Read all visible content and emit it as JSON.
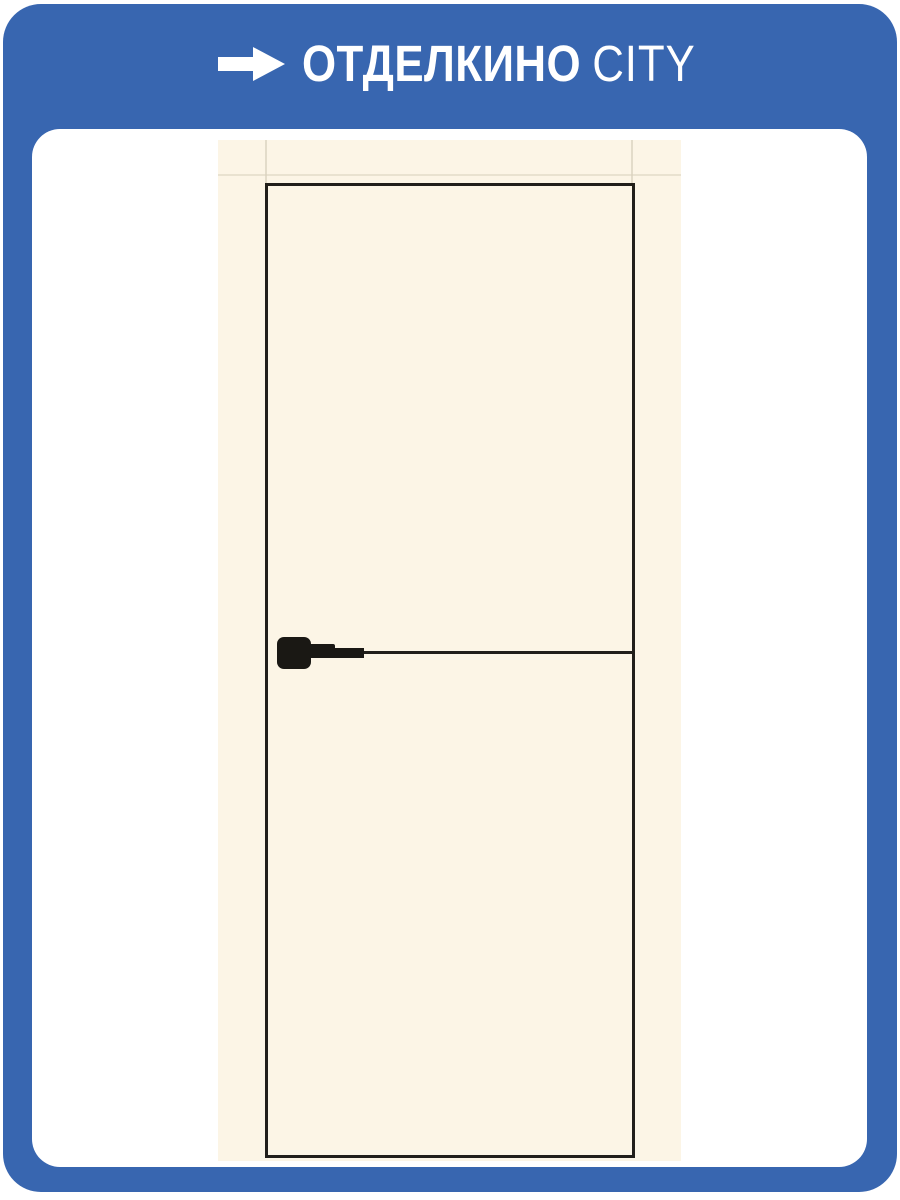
{
  "logo": {
    "primary": "ОТДЕЛКИНО",
    "secondary": "CITY",
    "arrow_icon": "arrow-right-icon"
  },
  "product_image": {
    "description": "Cream interior door in frame with black edge trim, black horizontal molding at handle level and black square-rosette lever handle"
  },
  "colors": {
    "background-blue": "#3866B0",
    "card-white": "#FFFFFF",
    "door-cream": "#FCF5E6",
    "trim-black": "#211F1A",
    "hardware-black": "#1A1814"
  }
}
